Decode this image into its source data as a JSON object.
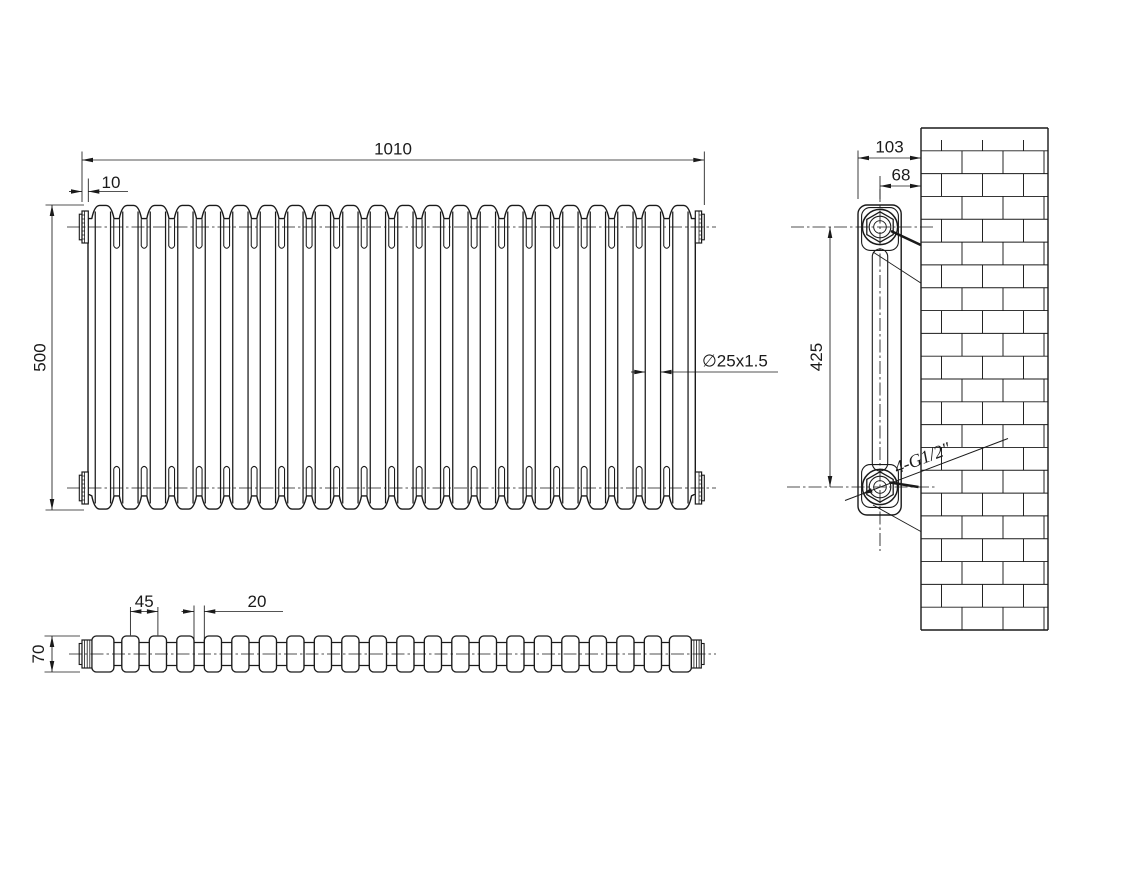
{
  "drawing": {
    "type": "technical-drawing",
    "subject": "column-radiator-dimension-drawing",
    "background_color": "#ffffff",
    "line_color": "#1a1a1a",
    "front_view": {
      "dim_overall_width": "1010",
      "dim_end_plug_offset": "10",
      "dim_overall_height": "500",
      "dim_column_tube": "∅25x1.5"
    },
    "side_view": {
      "dim_depth_to_wall": "103",
      "dim_center_to_wall": "68",
      "dim_tapping_centers": "425",
      "label_connections": "4-G1/2\""
    },
    "plan_view": {
      "dim_section_pitch": "45",
      "dim_column_gap": "20",
      "dim_depth": "70"
    }
  }
}
